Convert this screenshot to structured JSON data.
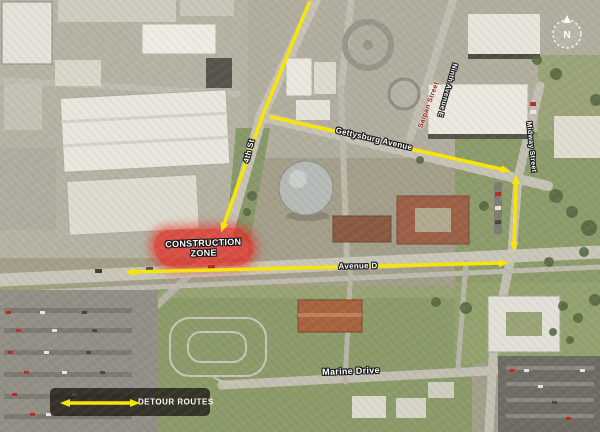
{
  "map": {
    "compass": {
      "letter": "N"
    },
    "construction_zone": {
      "line1": "CONSTRUCTION",
      "line2": "ZONE",
      "fill_color": "#e8281e"
    },
    "legend": {
      "label": "DETOUR ROUTES"
    },
    "street_labels": [
      {
        "id": "gettysburg-avenue",
        "text": "Gettysburg Avenue",
        "x": 374,
        "y": 139,
        "rot": 13
      },
      {
        "id": "4th-st",
        "text": "4th St",
        "x": 249,
        "y": 151,
        "rot": -76
      },
      {
        "id": "saipan-street",
        "text": "Saipan Street",
        "x": 429,
        "y": 105,
        "rot": -70,
        "color": "#8c2016",
        "size": 7
      },
      {
        "id": "ninth-avenue-e",
        "text": "Ninth Avenue E",
        "x": 447,
        "y": 90,
        "rot": 106,
        "size": 7
      },
      {
        "id": "midway-street",
        "text": "Midway Street",
        "x": 531,
        "y": 147,
        "rot": 84,
        "size": 7
      },
      {
        "id": "avenue-d",
        "text": "Avenue D",
        "x": 358,
        "y": 266,
        "rot": -1
      },
      {
        "id": "marine-drive",
        "text": "Marine Drive",
        "x": 351,
        "y": 371,
        "rot": -2,
        "size": 9
      }
    ],
    "routes": {
      "color": "#f8e408",
      "segments": [
        {
          "id": "route-4th-st-north",
          "points": [
            [
              309,
              3
            ],
            [
              264,
              112
            ]
          ],
          "arrow_start": false,
          "arrow_end": false
        },
        {
          "id": "route-4th-st-south",
          "points": [
            [
              264,
              112
            ],
            [
              223,
              227
            ]
          ],
          "arrow_start": false,
          "arrow_end": true
        },
        {
          "id": "route-gettysburg-west",
          "points": [
            [
              271,
              117
            ],
            [
              334,
              131
            ]
          ],
          "arrow_start": false,
          "arrow_end": false
        },
        {
          "id": "route-gettysburg-east",
          "points": [
            [
              398,
              146
            ],
            [
              505,
              170
            ]
          ],
          "arrow_start": false,
          "arrow_end": true
        },
        {
          "id": "route-midway-street",
          "points": [
            [
              516,
              180
            ],
            [
              514,
              246
            ]
          ],
          "arrow_start": true,
          "arrow_end": true
        },
        {
          "id": "route-avenue-d",
          "points": [
            [
              131,
              272
            ],
            [
              503,
              263
            ]
          ],
          "arrow_start": true,
          "arrow_end": true
        },
        {
          "id": "legend-arrow",
          "points": [
            [
              66,
              403
            ],
            [
              134,
              403
            ]
          ],
          "arrow_start": true,
          "arrow_end": true
        }
      ]
    }
  }
}
